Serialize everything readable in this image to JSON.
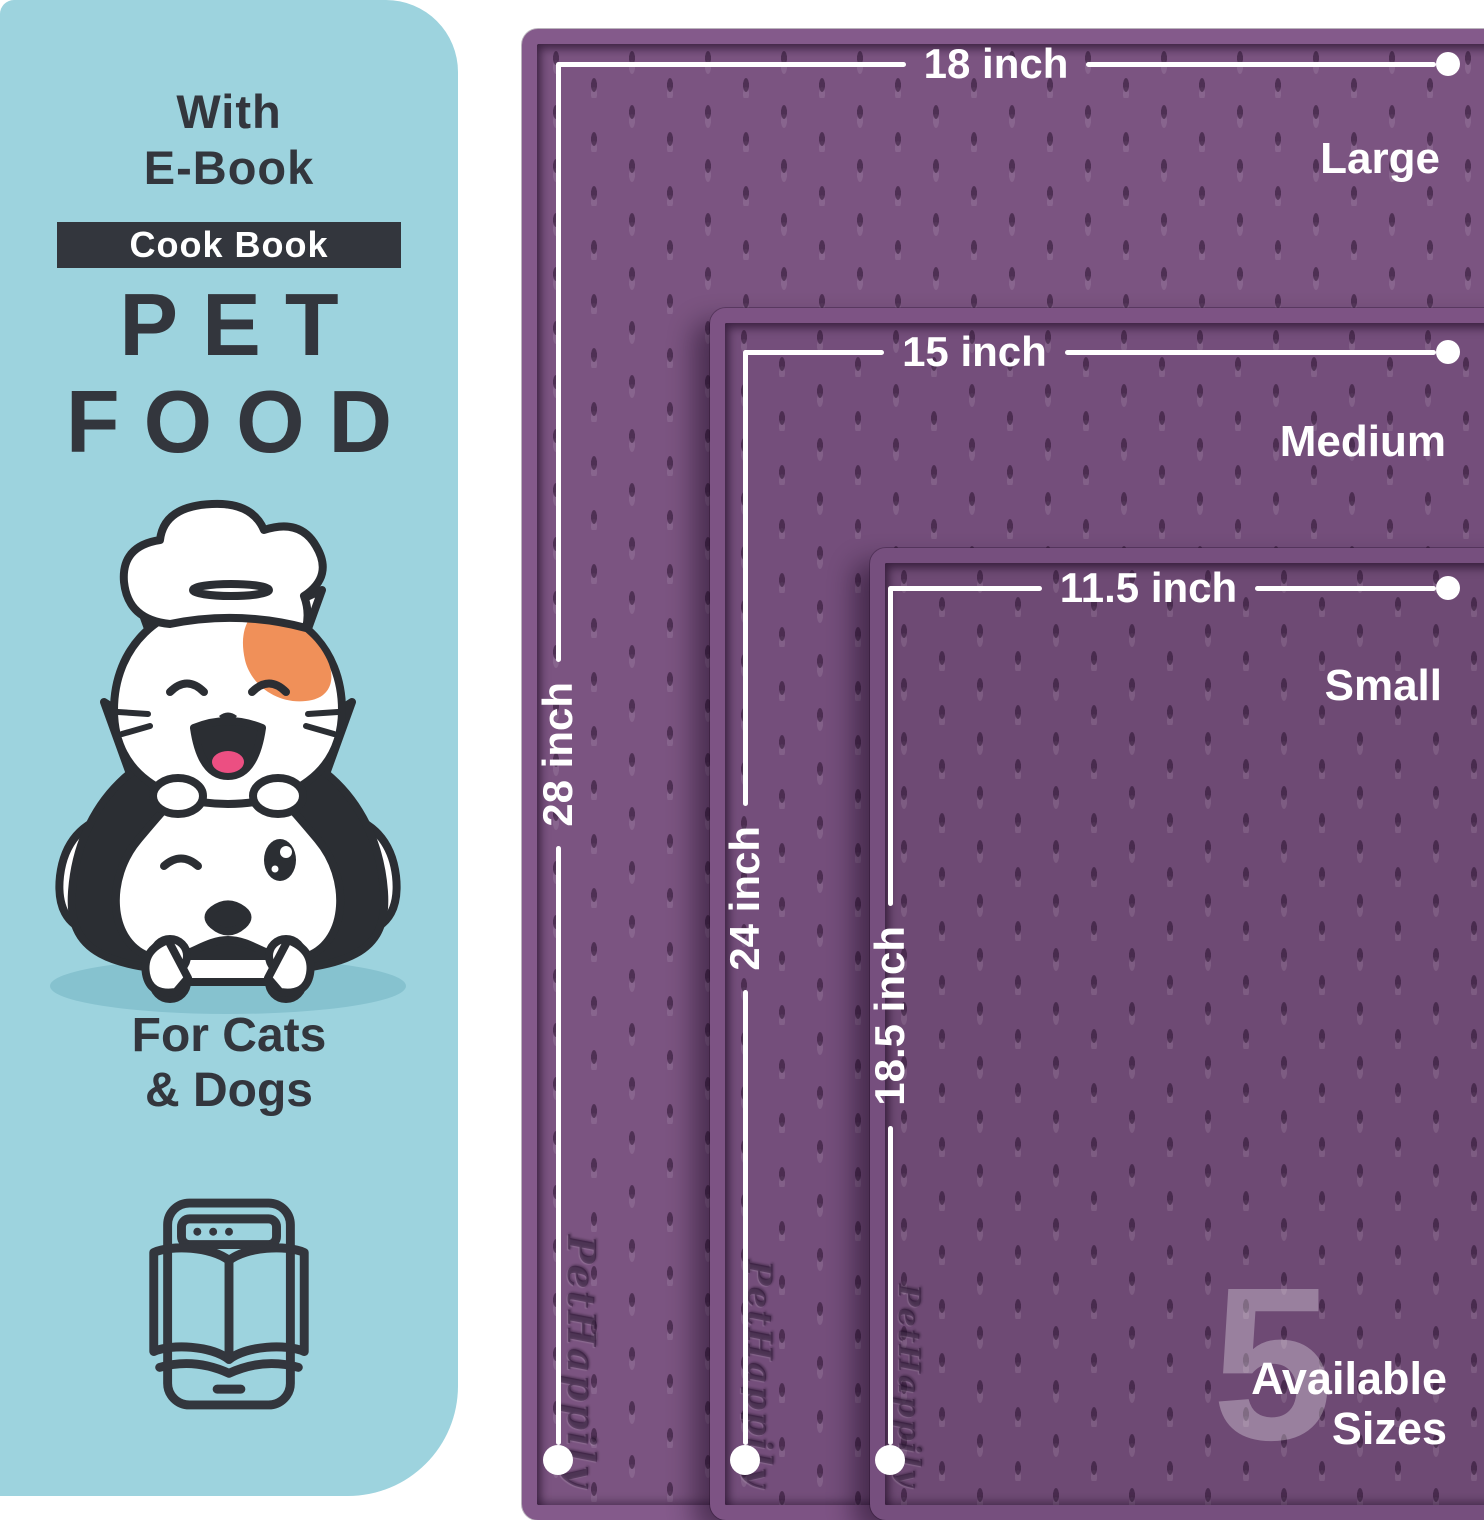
{
  "panel": {
    "with": "With",
    "ebook": "E-Book",
    "badge": "Cook Book",
    "pet": "PET",
    "food": "FOOD",
    "for_cats": "For Cats",
    "and_dogs": "& Dogs"
  },
  "mats": {
    "brand_emboss": "PetHappily",
    "items": [
      {
        "size": "Large",
        "width": "18 inch",
        "height": "28 inch"
      },
      {
        "size": "Medium",
        "width": "15 inch",
        "height": "24 inch"
      },
      {
        "size": "Small",
        "width": "11.5 inch",
        "height": "18.5 inch"
      }
    ]
  },
  "sizes_badge": {
    "number": "5",
    "line1": "Available",
    "line2": "Sizes"
  },
  "icons": {
    "ebook": "ebook-tablet-icon",
    "illustration": "chef-cat-and-dog-illustration"
  },
  "colors": {
    "panel_blue": "#9dd3de",
    "ink": "#33363d",
    "mat_large": "#7b5481",
    "mat_medium": "#744e7b",
    "mat_small": "#6e4a74",
    "line_white": "#ffffff",
    "patch_orange": "#f09059",
    "pink": "#f26f98"
  }
}
